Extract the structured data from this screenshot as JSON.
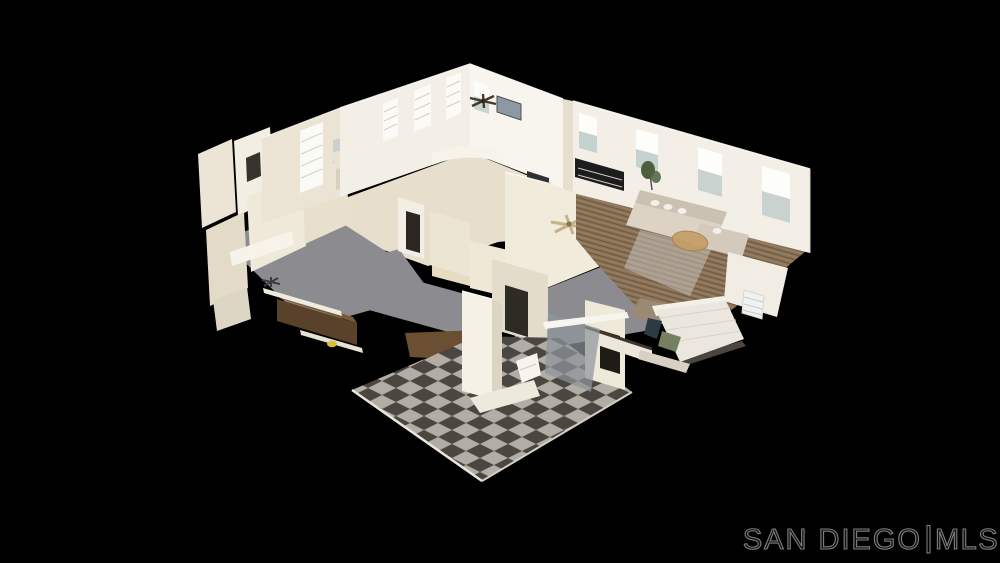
{
  "scene": {
    "description": "Aerial 3D dollhouse cutaway view of a staged single-story home interior (photogrammetry model) floating on a black background"
  },
  "watermark": {
    "brand": "SAN DIEGO",
    "suffix": "MLS",
    "stroke_color": "#7e7e7e"
  },
  "colors": {
    "background": "#000000",
    "wall_light": "#f3efe6",
    "wall_cream": "#e9e1cf",
    "interior_floor": "#e7dfcc",
    "carpet_gray": "#8c8c90",
    "wood_base": "#8b7358",
    "wood_stripe": "#6d573f",
    "tile_light": "#b2aea6",
    "tile_dark": "#4b463f",
    "sofa_beige": "#dcd3c5",
    "rug_tan": "#c59e66",
    "bed_white": "#ebe6de",
    "stair_wood": "#5a4129",
    "bedroom_floor": "#9a8a74",
    "glass_gray": "#8f969b"
  }
}
